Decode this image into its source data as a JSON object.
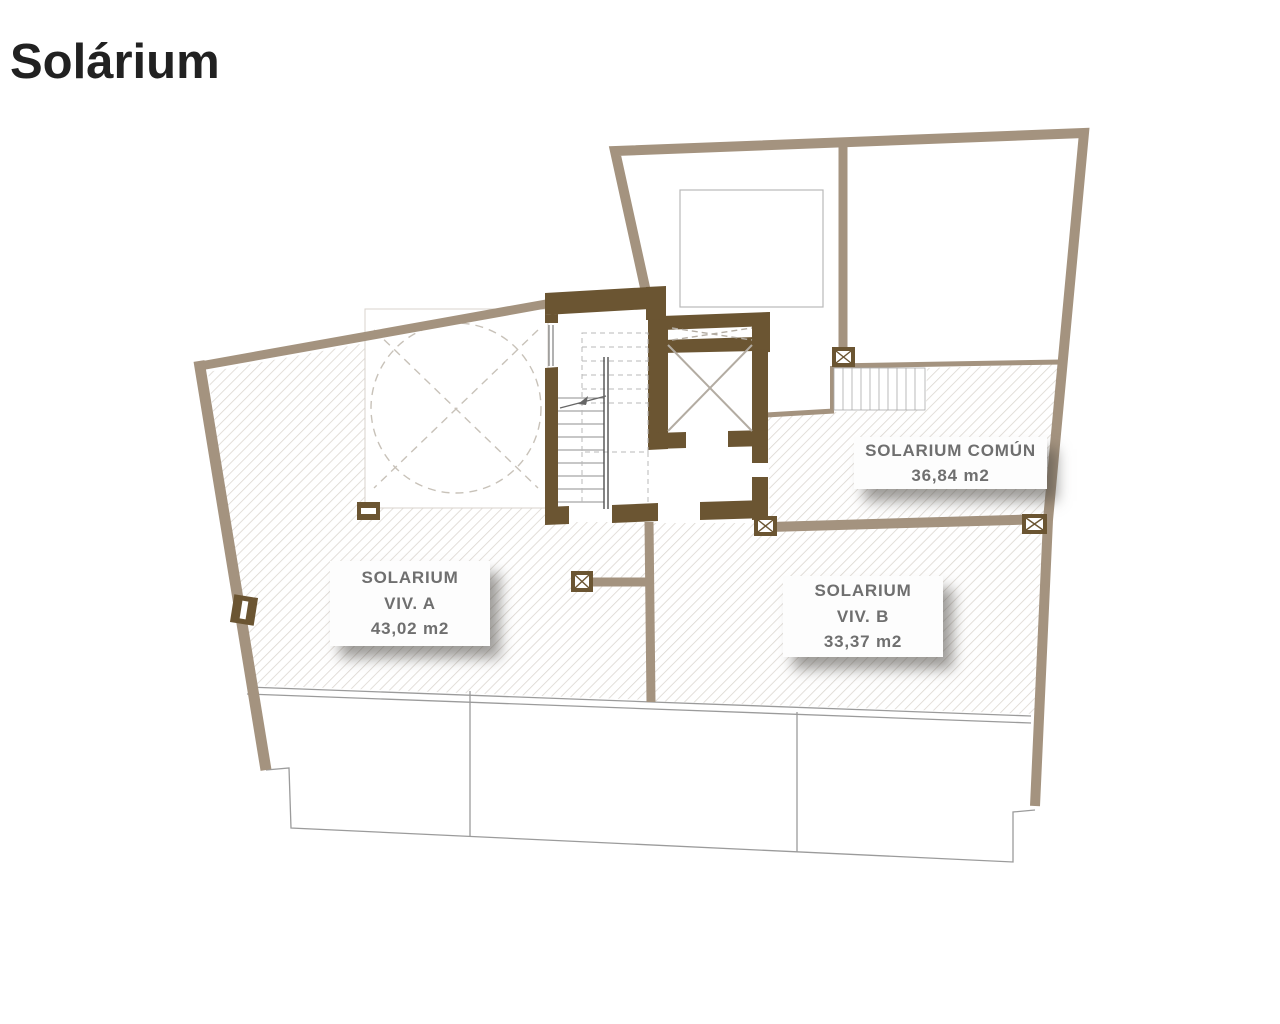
{
  "title": "Solárium",
  "plan": {
    "area_labels": {
      "viv_a": {
        "lines": [
          "SOLARIUM",
          "VIV. A",
          "43,02 m2"
        ]
      },
      "viv_b": {
        "lines": [
          "SOLARIUM",
          "VIV. B",
          "33,37 m2"
        ]
      },
      "comun": {
        "lines": [
          "SOLARIUM COMÚN",
          "36,84 m2"
        ]
      }
    },
    "colors": {
      "wall_light": "#a4937f",
      "wall_dark": "#6b5532",
      "hatch_line": "#dcd7d1",
      "outline_gray": "#9b9b9b",
      "label_text": "#6f6f6f",
      "title_text": "#212121"
    }
  }
}
